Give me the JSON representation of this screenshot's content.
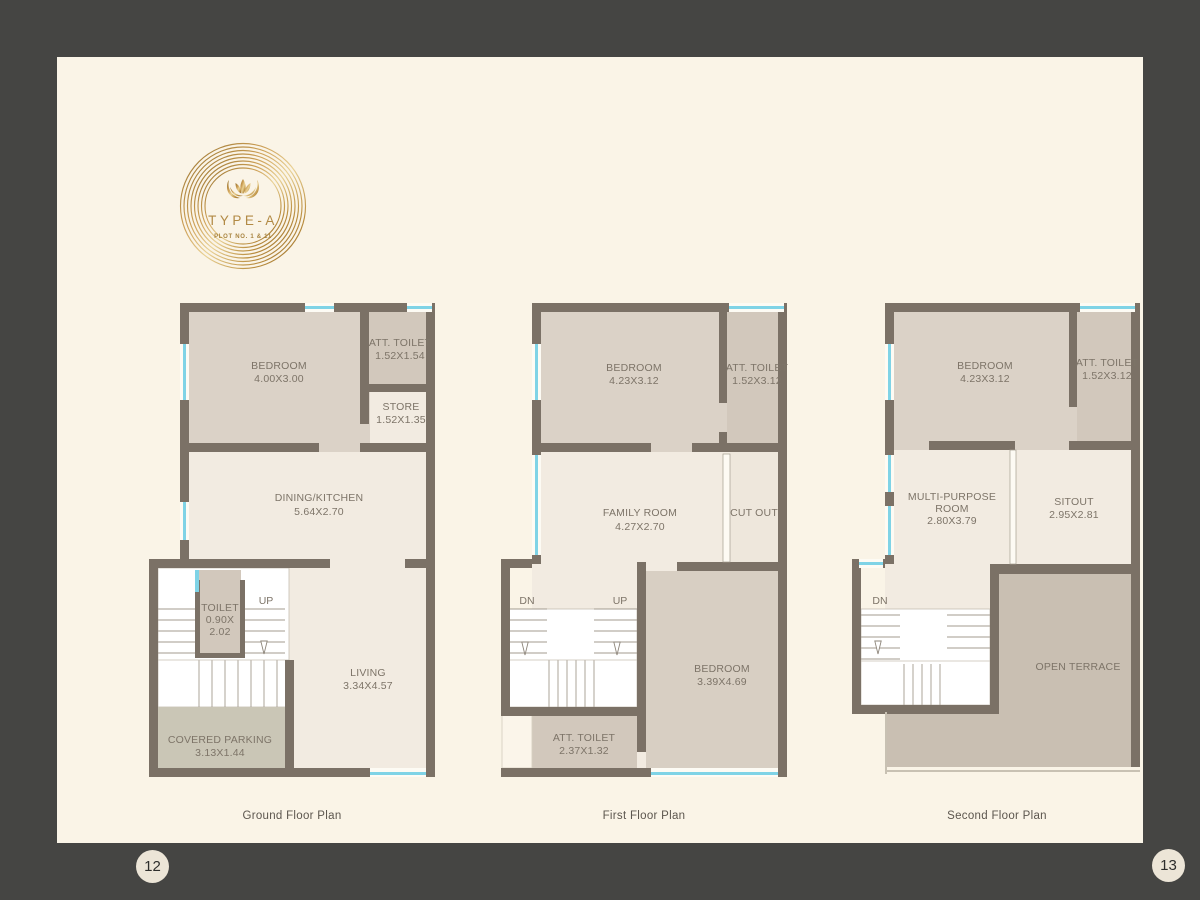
{
  "page": {
    "left_page_number": "12",
    "right_page_number": "13"
  },
  "logo": {
    "title": "TYPE-A",
    "subtitle": "PLOT NO. 1 & 11"
  },
  "colors": {
    "border": "#454543",
    "paper": "#faf4e7",
    "wall": "#7b7166",
    "room_beige": "#dbd2c7",
    "room_dark_beige": "#d2c8bc",
    "room_cream": "#f2ebe1",
    "terrace": "#c9bfb2",
    "parking": "#cac6b6",
    "window_cyan": "#7fd3e6",
    "gold": "#c89c52"
  },
  "plans": [
    {
      "caption": "Ground Floor Plan",
      "labels": {
        "bedroom_name": "BEDROOM",
        "bedroom_dim": "4.00X3.00",
        "att_toilet_name": "ATT. TOILET",
        "att_toilet_dim": "1.52X1.54",
        "store_name": "STORE",
        "store_dim": "1.52X1.35",
        "dining_name": "DINING/KITCHEN",
        "dining_dim": "5.64X2.70",
        "toilet_name": "TOILET",
        "toilet_dim_a": "0.90X",
        "toilet_dim_b": "2.02",
        "up": "UP",
        "living_name": "LIVING",
        "living_dim": "3.34X4.57",
        "parking_name": "COVERED PARKING",
        "parking_dim": "3.13X1.44"
      }
    },
    {
      "caption": "First Floor Plan",
      "labels": {
        "bedroom1_name": "BEDROOM",
        "bedroom1_dim": "4.23X3.12",
        "att_toilet1_name": "ATT. TOILET",
        "att_toilet1_dim": "1.52X3.12",
        "family_name": "FAMILY ROOM",
        "family_dim": "4.27X2.70",
        "cutout": "CUT OUT",
        "dn": "DN",
        "up": "UP",
        "bedroom2_name": "BEDROOM",
        "bedroom2_dim": "3.39X4.69",
        "att_toilet2_name": "ATT. TOILET",
        "att_toilet2_dim": "2.37X1.32"
      }
    },
    {
      "caption": "Second Floor Plan",
      "labels": {
        "bedroom_name": "BEDROOM",
        "bedroom_dim": "4.23X3.12",
        "att_toilet_name": "ATT. TOILET",
        "att_toilet_dim": "1.52X3.12",
        "mpr_name_1": "MULTI-PURPOSE",
        "mpr_name_2": "ROOM",
        "mpr_dim": "2.80X3.79",
        "sitout_name": "SITOUT",
        "sitout_dim": "2.95X2.81",
        "dn": "DN",
        "terrace_name": "OPEN TERRACE"
      }
    }
  ]
}
